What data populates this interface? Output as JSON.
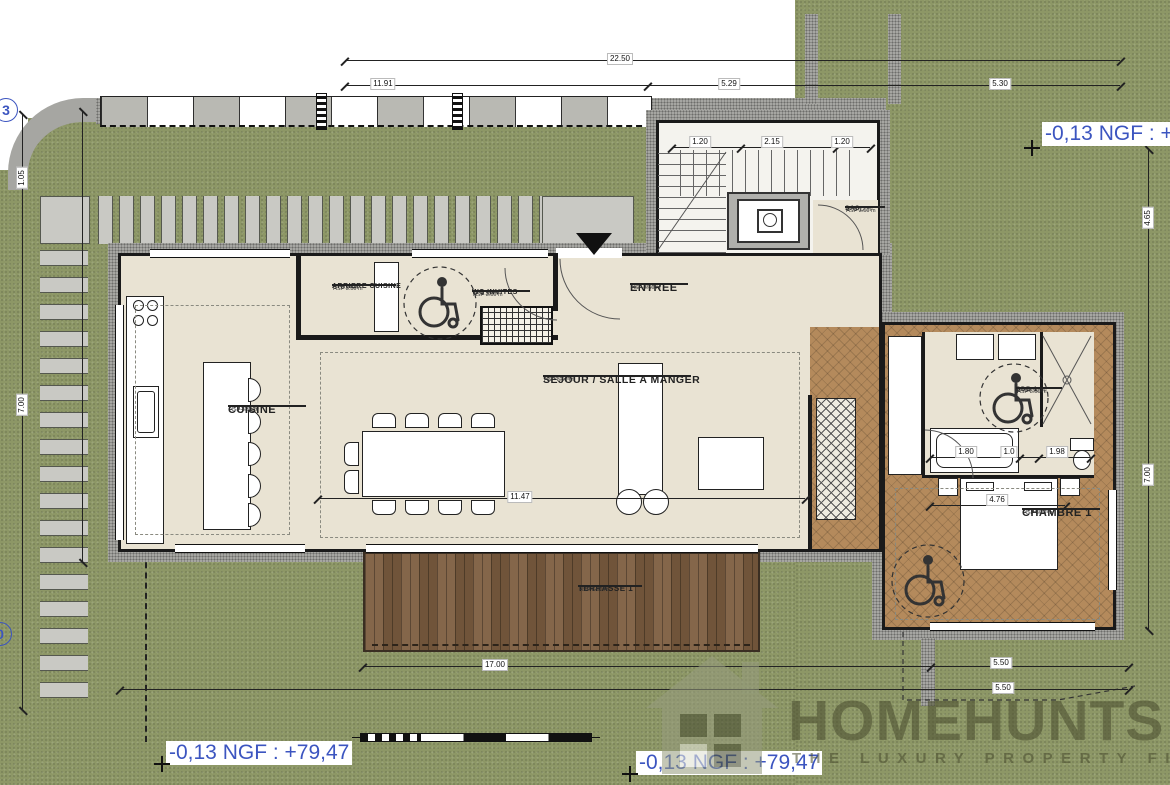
{
  "levels": {
    "marker_text": "-0,13 NGF : +79,47"
  },
  "logo": {
    "title": "HOMEHUNTS",
    "tagline": "THE LUXURY PROPERTY FINDERS"
  },
  "rooms": {
    "cuisine": {
      "name": "CUISINE",
      "area": "S : 23.51 m²",
      "height": "HSP 3.50 m"
    },
    "arriere": {
      "name": "ARRIERE CUISINE",
      "area": "S : 5.04 m²",
      "height": "HSP 3.50 m"
    },
    "wc": {
      "name": "WC INVITES",
      "area": "S : 3.55 m²",
      "height": "HSP 3.50 m"
    },
    "entree": {
      "name": "ENTREE",
      "area": "S : 5.16 m²",
      "height": "HSP 3.50 m"
    },
    "sejour": {
      "name": "SEJOUR / SALLE A MANGER",
      "area": "S : 58.52 m²",
      "height": "HSP 3.50 m"
    },
    "sas": {
      "name": "SAS",
      "area": "S : 3.12 m²",
      "height": "HSP 3.50 m"
    },
    "sdb1": {
      "name": "SDB 1",
      "area": "S : 10.56 m²",
      "height": "HSP 3.50 m"
    },
    "chambre1": {
      "name": "CHAMBRE 1",
      "area": "S : 21.8 m²",
      "height": "HSP 3.50 m"
    },
    "terrasse1": {
      "name": "TERRASSE 1",
      "area": "S : 65.26 m²",
      "height": "HSP 3.50 m"
    }
  },
  "dims": {
    "overall_width": "22.50",
    "left_part": "11.91",
    "mid_part": "5.29",
    "right_part": "5.30",
    "stair_a": "1.20",
    "stair_b": "2.15",
    "stair_c": "1.20",
    "bottom_main": "17.00",
    "bottom_right_a": "5.50",
    "bottom_right_b": "5.50",
    "left_a": "1.05",
    "left_b": "7.00",
    "right_a": "4.65",
    "right_b": "7.00",
    "bed_width": "4.76",
    "bath_a": "1.80",
    "bath_b": "1.0",
    "bath_c": "1.98",
    "sejour_width": "11.47"
  },
  "markers": {
    "left_top": "3",
    "left_bottom": "0"
  },
  "colors": {
    "annotation_blue": "#3c55c0",
    "grass": "#8d9766",
    "deck": "#7d5e40",
    "parquet": "#b48a5c",
    "floor_beige": "#e9e3d3",
    "wall_gray": "#a6a6a2"
  }
}
